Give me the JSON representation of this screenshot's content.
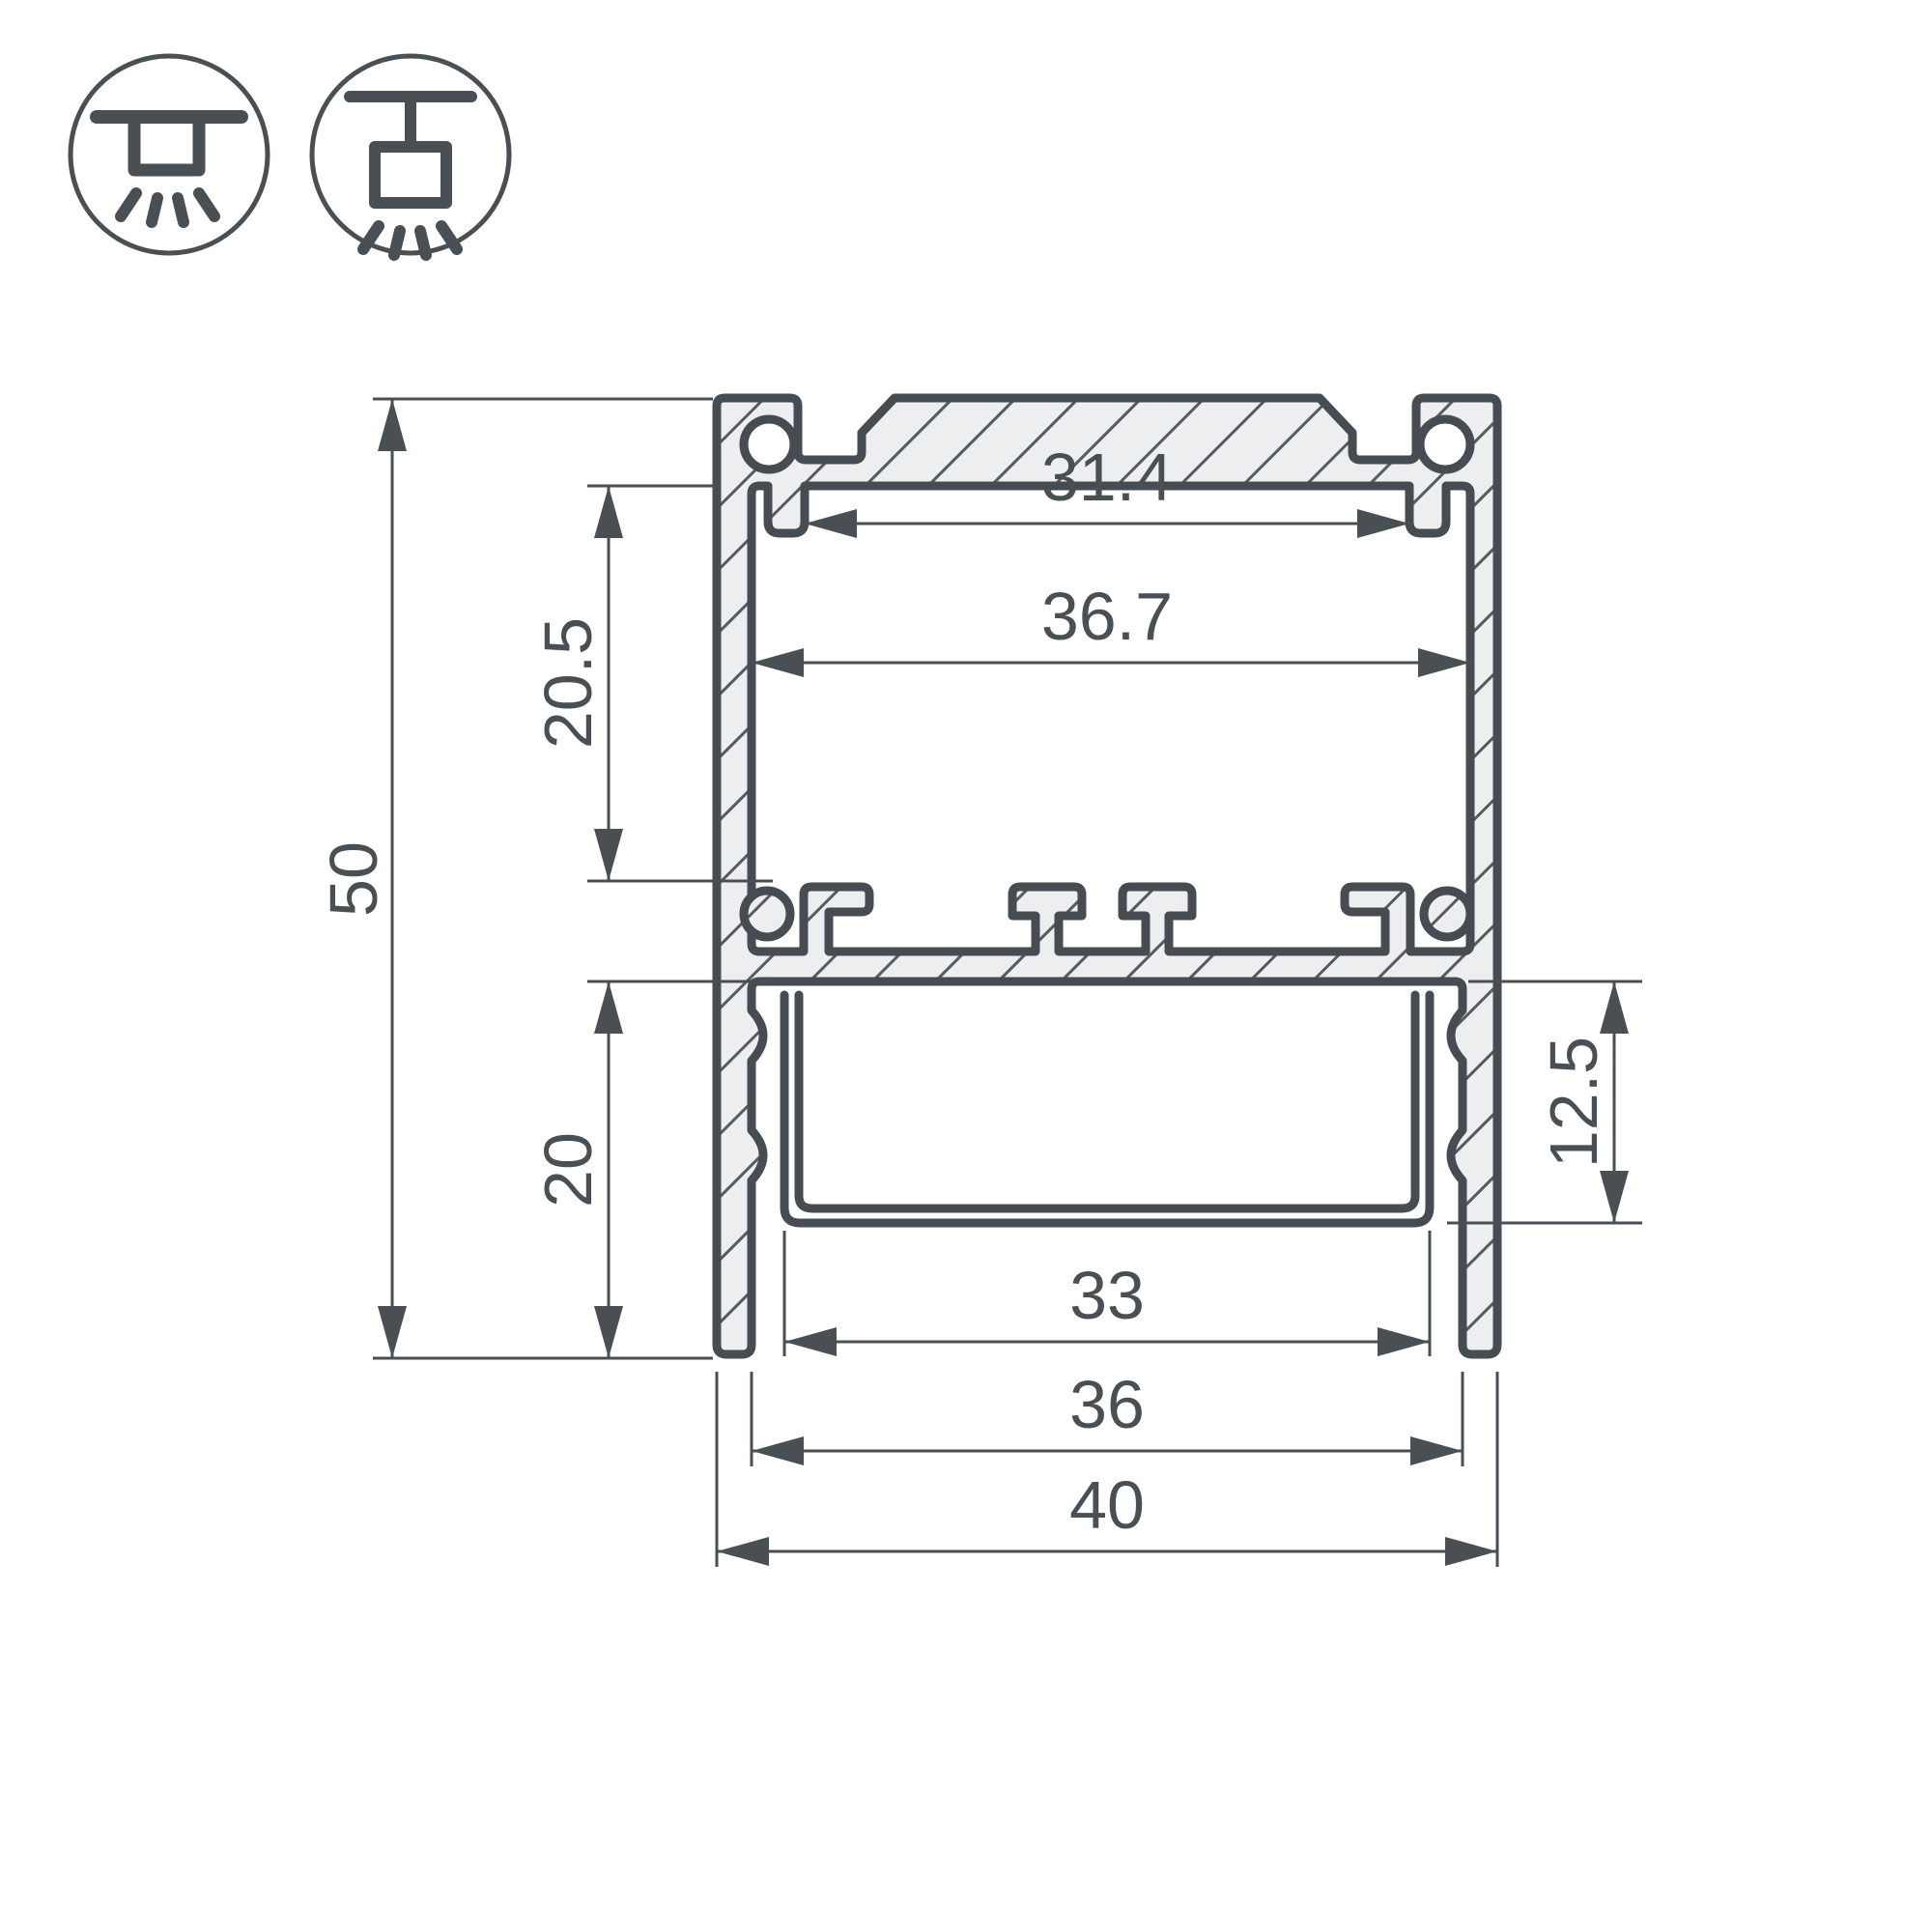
{
  "colors": {
    "line": "#4a4f54",
    "outline": "#474c52",
    "metal_fill": "#edeef0",
    "background": "#ffffff"
  },
  "icons": {
    "surface_mount": "surface-mount-ceiling-light-icon",
    "pendant_mount": "suspended-ceiling-light-icon"
  },
  "dimensions": {
    "total_height": "50",
    "total_width": "40",
    "top_opening_width": "31.4",
    "inner_width": "36.7",
    "upper_chamber_height": "20.5",
    "lower_chamber_height": "20",
    "diffuser_depth": "12.5",
    "diffuser_width": "33",
    "bottom_width": "36"
  }
}
